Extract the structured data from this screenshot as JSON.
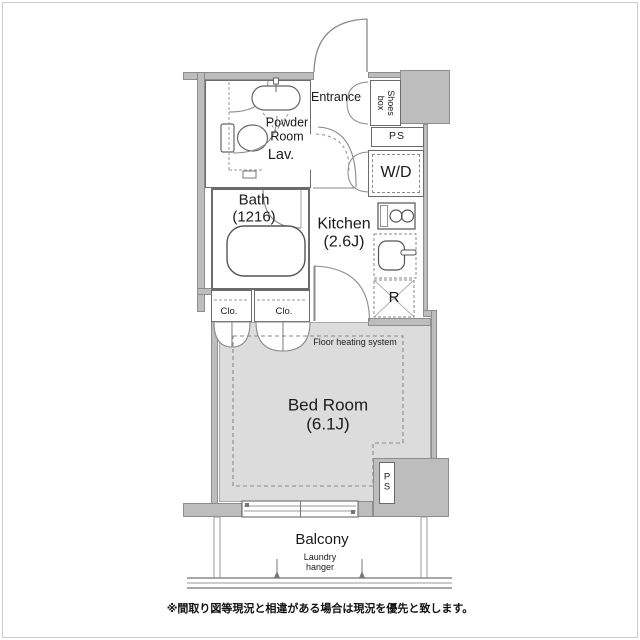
{
  "colors": {
    "wall_fill": "#bdbdbd",
    "wall_outline": "#8d8d8d",
    "floor_fill": "#dcdcdc",
    "line": "#555555",
    "background": "#ffffff"
  },
  "labels": {
    "entrance": "Entrance",
    "shoes_box": "Shoes\nbox",
    "ps_upper": "PS",
    "washer_dryer": "W/D",
    "powder_room": "Powder\nRoom",
    "lavatory": "Lav.",
    "bath": "Bath\n(1216)",
    "kitchen": "Kitchen\n(2.6J)",
    "closet_left": "Clo.",
    "closet_right": "Clo.",
    "refrigerator": "R",
    "floor_heating": "Floor heating system",
    "bed_room": "Bed Room\n(6.1J)",
    "pipe_space": "P\nS",
    "balcony": "Balcony",
    "laundry_hanger": "Laundry\nhanger"
  },
  "footer": {
    "note": "※間取り図等現況と相違がある場合は現況を優先と致します。"
  }
}
